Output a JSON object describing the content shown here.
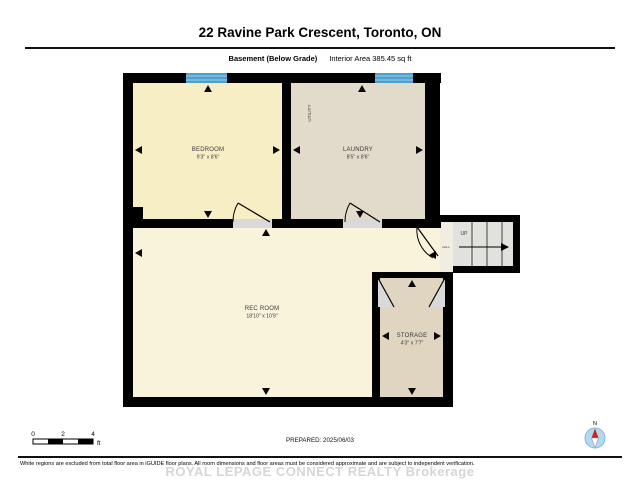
{
  "header": {
    "title": "22 Ravine Park Crescent, Toronto, ON",
    "floor_label": "Basement (Below Grade)",
    "area_label": "Interior Area 385.45 sq ft"
  },
  "plan": {
    "bedroom": {
      "name": "BEDROOM",
      "dims": "9'3\" x 8'6\""
    },
    "laundry": {
      "name": "LAUNDRY",
      "dims": "8'5\" x 8'6\""
    },
    "rec_room": {
      "name": "REC ROOM",
      "dims": "18'10\" x 10'9\""
    },
    "storage": {
      "name": "STORAGE",
      "dims": "4'3\" x 7'7\""
    },
    "utility_label": "UTILITY",
    "hall_label": "HALL",
    "stairs_label": "UP"
  },
  "scale_bar": {
    "ticks": [
      "0",
      "2",
      "4"
    ],
    "unit": "ft"
  },
  "footer": {
    "prepared": "PREPARED: 2025/06/03",
    "compass_label": "N",
    "disclaimer": "White regions are excluded from total floor area in iGUIDE floor plans. All room dimensions and floor areas must be considered approximate and are subject to independent verification.",
    "watermark": "ROYAL LEPAGE CONNECT REALTY Brokerage"
  },
  "colors": {
    "wall": "#000000",
    "bedroom_fill": "#F8EEC6",
    "laundry_fill": "#E2DBCB",
    "rec_room_fill": "#F9F3DC",
    "storage_fill": "#DFD5C1",
    "hall_fill": "#F1EDE0",
    "stairs_fill": "#E1E1DE",
    "door_fill": "#D9D9D9",
    "window_blue": "#4E9FCE",
    "window_stripe": "#8CC6E4",
    "compass_blue": "#B3D9EE",
    "compass_red": "#D22222"
  }
}
